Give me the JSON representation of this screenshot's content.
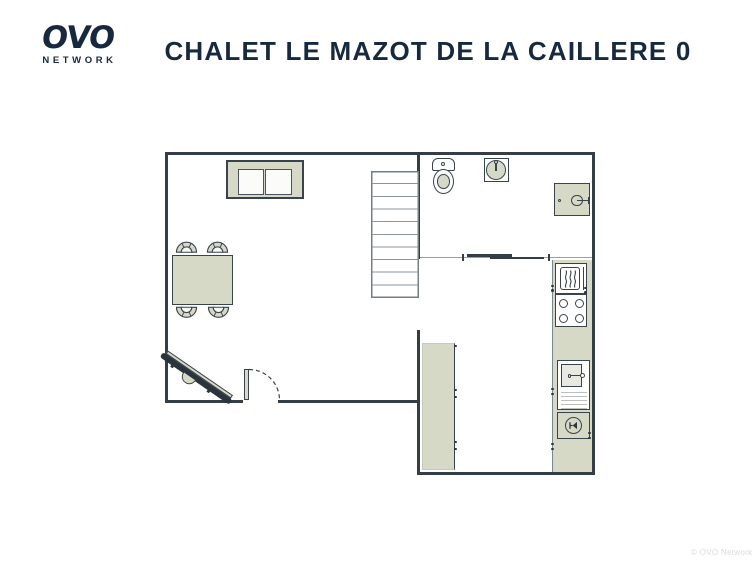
{
  "header": {
    "logo": {
      "mark": "OVO",
      "subtext": "NETWORK"
    },
    "title": "CHALET LE MAZOT DE LA CAILLERE 0"
  },
  "footer": {
    "watermark": "© OVO Network"
  },
  "colors": {
    "brand_navy": "#16293e",
    "wall_dark": "#353e46",
    "furniture_outline": "#39434c",
    "furniture_beige": "#d7d9c7",
    "stair_gray": "#79838b",
    "watermark_gray": "#dadada"
  },
  "floorplan": {
    "floor_label": "0",
    "staircase_steps": 10,
    "stove_burners": 4,
    "dining_chairs": 4,
    "rooms": [
      {
        "name": "living-dining-room",
        "items": [
          "sofa",
          "dining-table",
          "dining-chairs-x4",
          "tv-on-stand",
          "staircase",
          "hinged-door"
        ]
      },
      {
        "name": "bathroom",
        "items": [
          "toilet",
          "round-washbasin",
          "washing-machine",
          "sliding-door"
        ]
      },
      {
        "name": "kitchen",
        "items": [
          "oven",
          "stove-4-burners",
          "kitchen-sink-with-drainer",
          "dishwasher",
          "counter-run",
          "island-unit"
        ]
      }
    ]
  }
}
